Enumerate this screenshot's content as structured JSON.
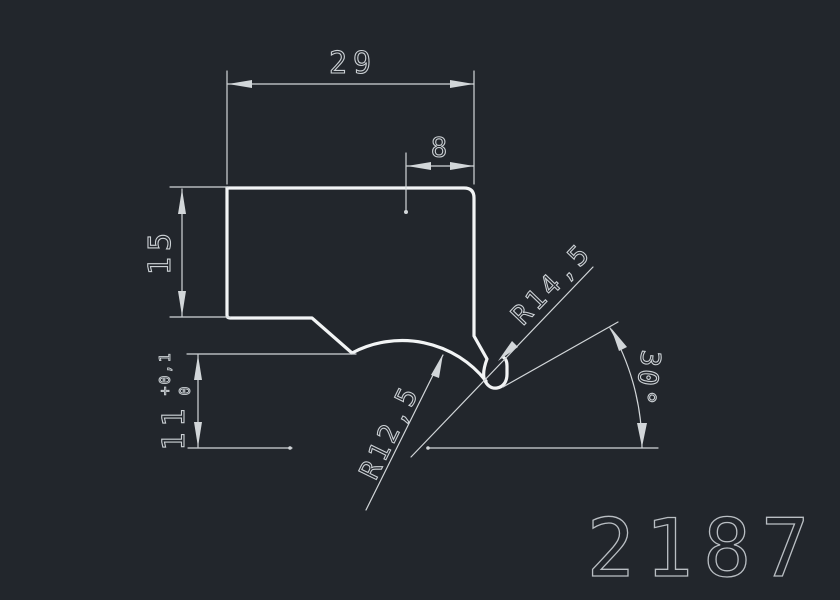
{
  "drawing": {
    "part_number": "2187"
  },
  "dimensions": {
    "overall_width": {
      "value": "29"
    },
    "step_width": {
      "value": "8"
    },
    "left_height": {
      "value": "15"
    },
    "lower_height": {
      "value": "11",
      "tolerance_upper": "+0,1",
      "tolerance_lower": "0"
    },
    "radius_lower": {
      "value": "R12,5"
    },
    "radius_hook": {
      "value": "R14,5"
    },
    "hook_angle": {
      "value": "30°"
    }
  },
  "colors": {
    "background": "#22262c",
    "profile_line": "#f2f4f5",
    "dimension_line": "#d2d6d9",
    "dimension_text": "#ccd1d5",
    "part_number_text": "#b9bec3"
  }
}
